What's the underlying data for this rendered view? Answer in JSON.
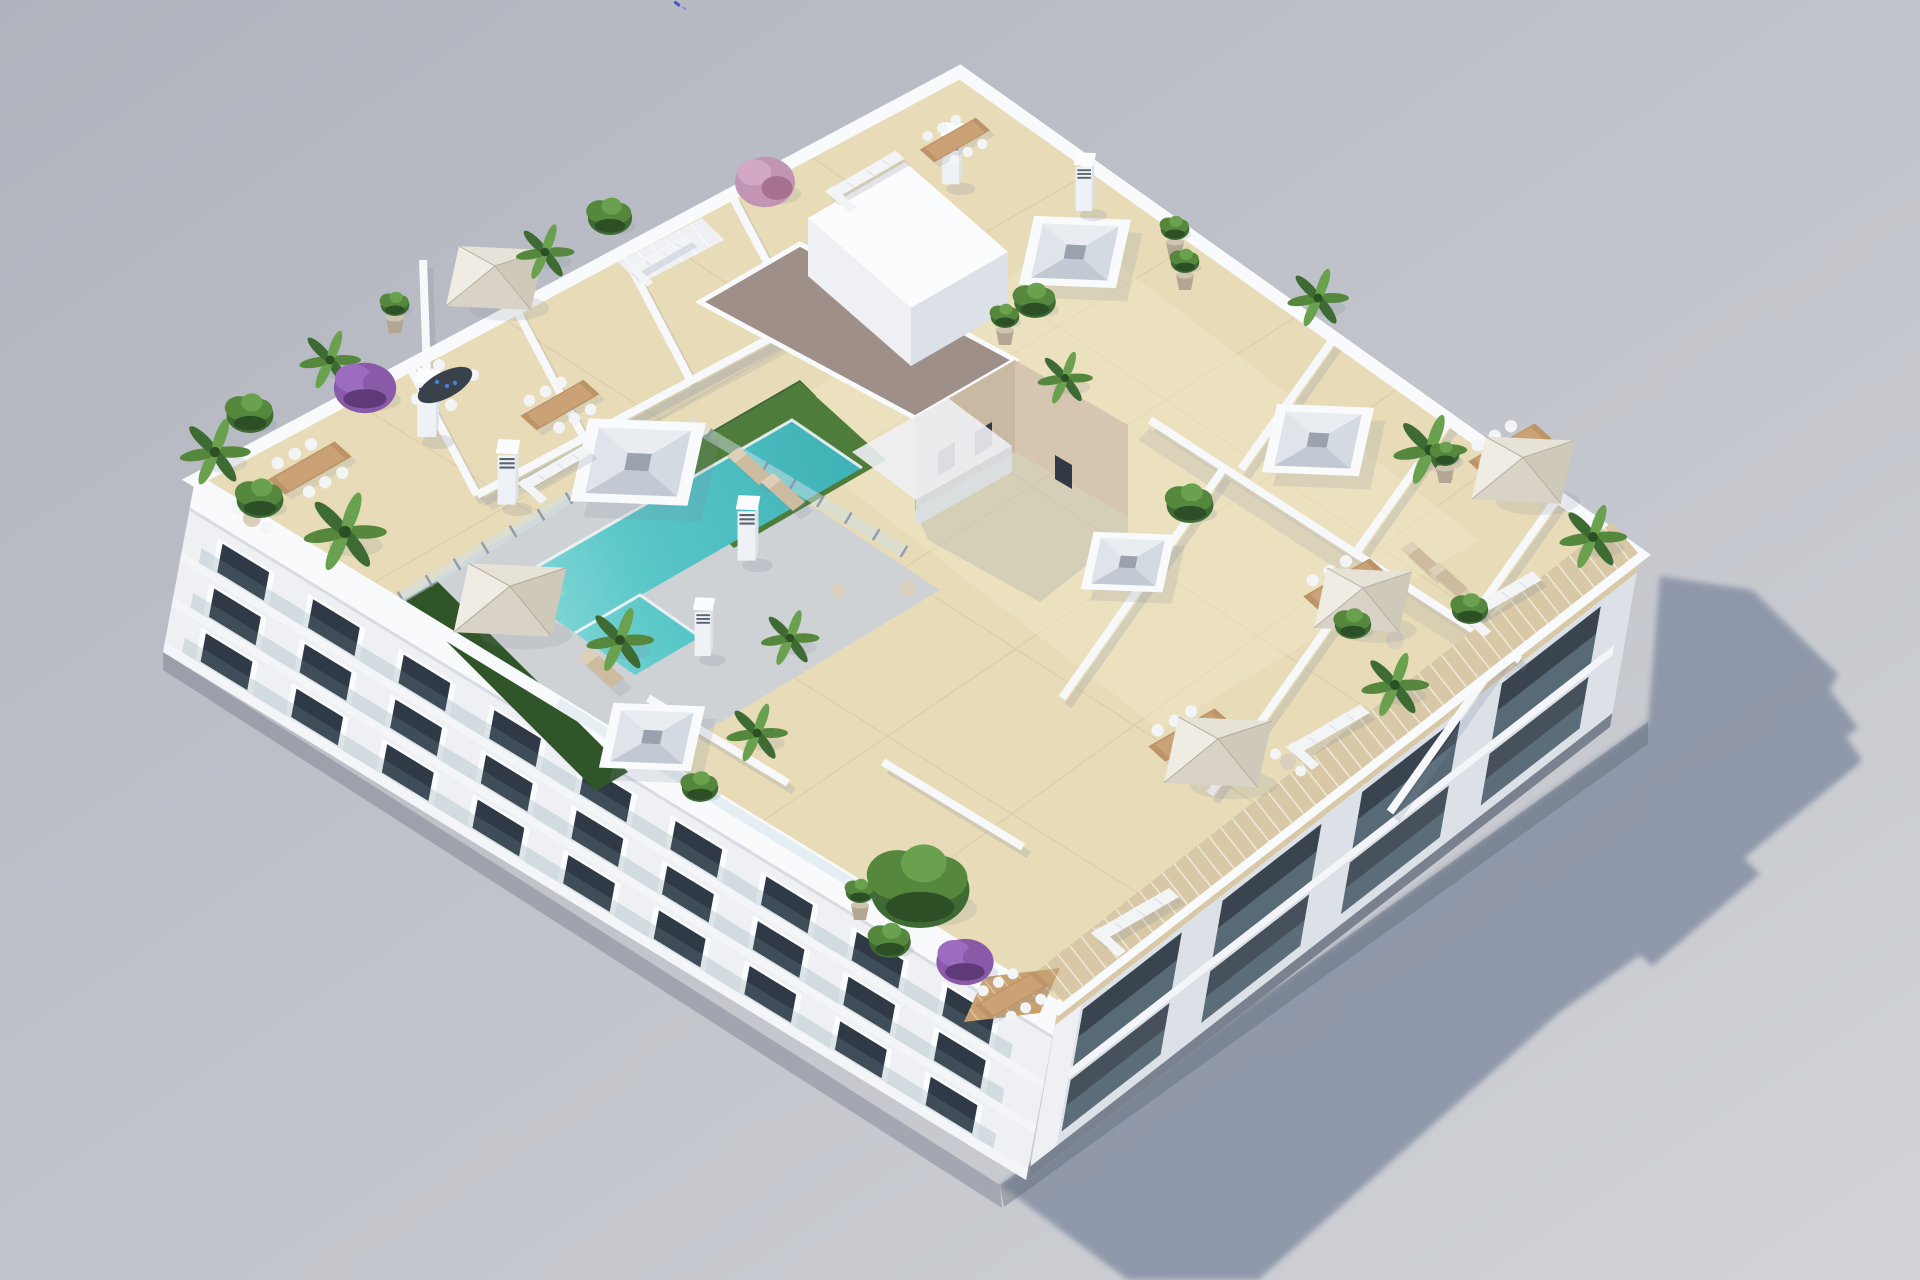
{
  "scene": {
    "description": "Aerial 3D architectural render of a white apartment block with a furnished rooftop terrace plan: L-shaped turquoise pool with glass fence and artificial grass, beige tiled private terraces divided by white walls, cream parasols, wooden dining sets, white lounge sofas, potted palms and flowering shrubs, a gravel-roofed stair core, skylight wells, louvred vent chimneys, a slatted timber pergola along the lower-right parapet, and a long blue-grey shadow cast on the plain grey ground to the lower right.",
    "objects": {
      "pool": "L-shaped rooftop swimming pool",
      "parasol_count": 5,
      "skylight_count": 5,
      "vent_chimney_count": 6,
      "dining_set_count": 7,
      "sofa_count": 6,
      "sun_lounger_count": 5
    },
    "palette": {
      "bg_top": "#b1b4be",
      "bg_bottom": "#d1d3d7",
      "shadow": "#8d96a9",
      "shadow_soft": "#7e889a",
      "contact": "#5f6877",
      "parapet": "#f8fafc",
      "wall_white": "#f6f8fa",
      "facade_light": "#eef0f4",
      "facade_side": "#dce1e8",
      "slab": "#f3f5f8",
      "frame": "#fbfcfd",
      "window_dark": "#303a46",
      "recess_dark": "#3a444f",
      "glass": "#74909d",
      "glass_rail": "#cfe0e8",
      "fence_post": "#8693a0",
      "plinth": "#7a8290",
      "shade_line": "#c9ced6",
      "tile": "#e8dcb8",
      "tile_light": "#f0e6c6",
      "grout": "#b9a87f",
      "deck": "#ced2d5",
      "pool": "#5ac7c9",
      "pool_deep": "#3fb3b7",
      "pool_light": "#86d8d8",
      "pool_edge": "#f2f4f6",
      "grass": "#4e7d3b",
      "hedge": "#2f5529",
      "gravel": "#9e9089",
      "core_tan": "#c9b8a2",
      "core_tan_light": "#d6c6b1",
      "wood": "#bd9468",
      "wood_light": "#caa276",
      "deck_wood": "#c8a171",
      "pergola": "#d8c8a6",
      "umb_light": "#efece4",
      "umb_top": "#e6e2d8",
      "umb_mid": "#d8d3c6",
      "umb_dark": "#cfc9ba",
      "umb_rib": "#b5b0a2",
      "white_f": "#f3f4f6",
      "cushion": "#e0e3e7",
      "lounger": "#cdbb9f",
      "lounger_light": "#ded0b8",
      "pouf": "#d9cfbc",
      "plant": "#3e6a33",
      "plant_mid": "#55883d",
      "plant_light": "#6aa14e",
      "plant_dark": "#2c4f26",
      "purple": "#8a5aa8",
      "purple_dark": "#5f3a78",
      "pink": "#c295b4",
      "pink_dark": "#a6718f",
      "pot": "#b3a794",
      "pot_rim": "#cfc4b2",
      "table_dark": "#39414b",
      "cup_blue": "#4a7fd4",
      "metal": "#8d949d",
      "vent": "#5a6470",
      "speck": "#4a55c8",
      "speck2": "#7d86dd"
    }
  }
}
